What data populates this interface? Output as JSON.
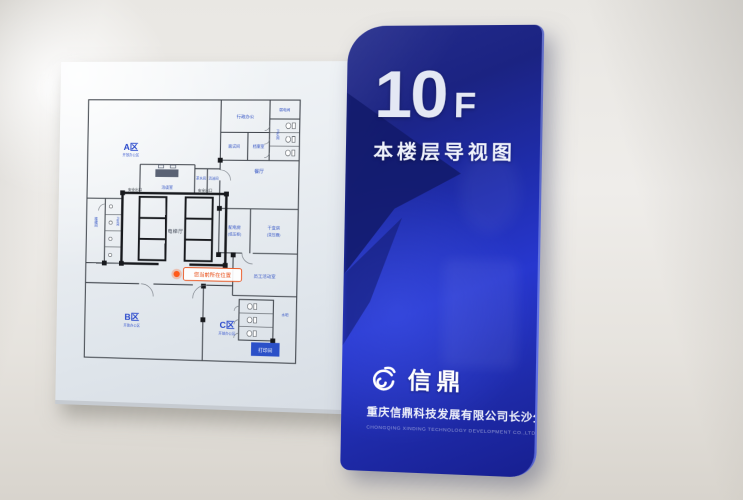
{
  "sign": {
    "floor_number": "10",
    "floor_suffix": "F",
    "subtitle": "本楼层导视图",
    "brand": {
      "logo": "xinding-swirl-icon",
      "name": "信鼎",
      "company_cn": "重庆信鼎科技发展有限公司长沙分公司",
      "company_en": "CHONGQING XINDING TECHNOLOGY DEVELOPMENT CO.,LTD CHANGSHA BRANCH"
    },
    "colors": {
      "panel_blue": "#2030b4",
      "panel_blue_dark": "#131b6c",
      "panel_blue_bright": "#2737cf",
      "label_blue": "#2a49cc",
      "marker_red": "#e8480f",
      "wall_line": "#41464d"
    }
  },
  "floorplan": {
    "zones": [
      {
        "name": "A区",
        "sub": "开放办公区"
      },
      {
        "name": "B区",
        "sub": "开放办公区"
      },
      {
        "name": "C区",
        "sub": "开放办公区"
      }
    ],
    "rooms": [
      {
        "name": "洽谈室"
      },
      {
        "name": "茶水间"
      },
      {
        "name": "清洁间"
      },
      {
        "name": "行政办公"
      },
      {
        "name": "弱电间"
      },
      {
        "name": "卫生间"
      },
      {
        "name": "面试间"
      },
      {
        "name": "档案室"
      },
      {
        "name": "餐厅"
      },
      {
        "name": "配电房",
        "sub": "(低压柜)"
      },
      {
        "name": "干变房",
        "sub": "(变压器)"
      },
      {
        "name": "员工活动室"
      },
      {
        "name": "水吧"
      },
      {
        "name": "打印间"
      },
      {
        "name": "楼梯间"
      },
      {
        "name": "卫生间"
      }
    ],
    "elevator_hall": "电梯厅",
    "exit_label": "安全出口",
    "you_are_here": "您当前所在位置"
  }
}
